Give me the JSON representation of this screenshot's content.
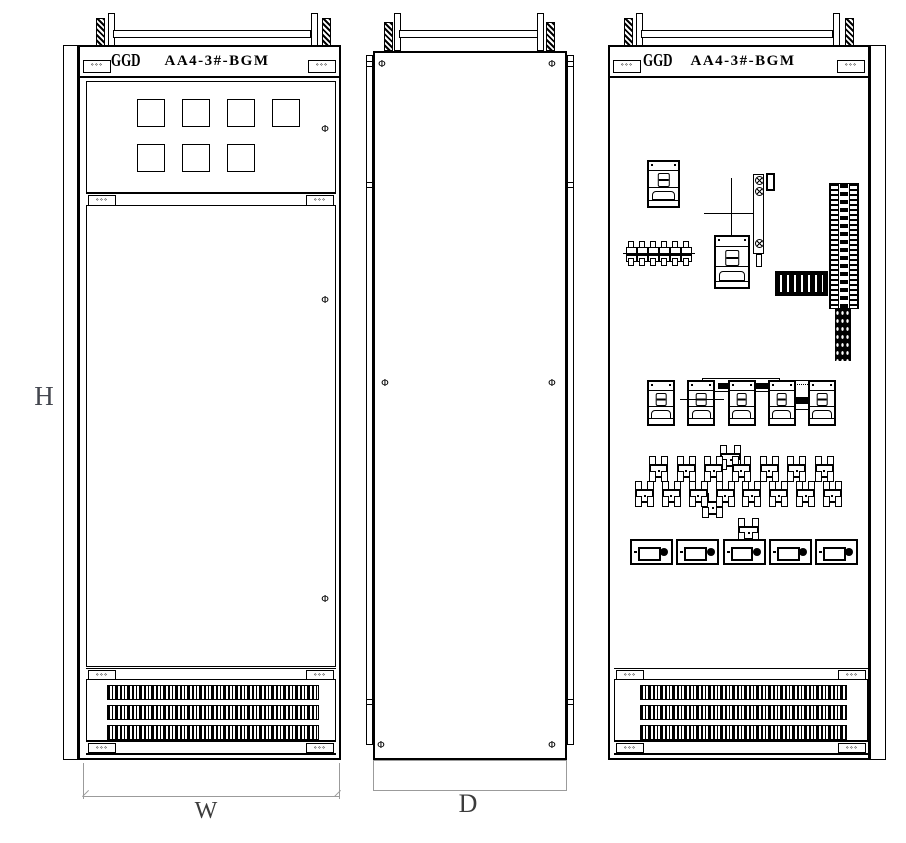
{
  "colors": {
    "line": "#000000",
    "dim_line": "#9b9b9b",
    "dim_text": "#3c3c3c",
    "background": "#ffffff"
  },
  "cabinet": {
    "brand": "GGD",
    "tag": "AA4-3#-BGM"
  },
  "dims": {
    "height": "H",
    "width": "W",
    "depth": "D"
  },
  "symbols": {
    "door_handle": "Φ",
    "hinge_screws": "⋄⋄⋄"
  },
  "front_view": {
    "meter_windows_row1": 4,
    "meter_windows_row2": 3,
    "vent_slat_rows": 3
  },
  "side_view": {
    "screw_pairs": 3
  },
  "internal_view": {
    "breaker_row": 5,
    "relay_row_top": 7,
    "relay_row_bottom": 8,
    "connector_row": 5,
    "terminal_row": 6,
    "vent_slat_rows": 3
  }
}
